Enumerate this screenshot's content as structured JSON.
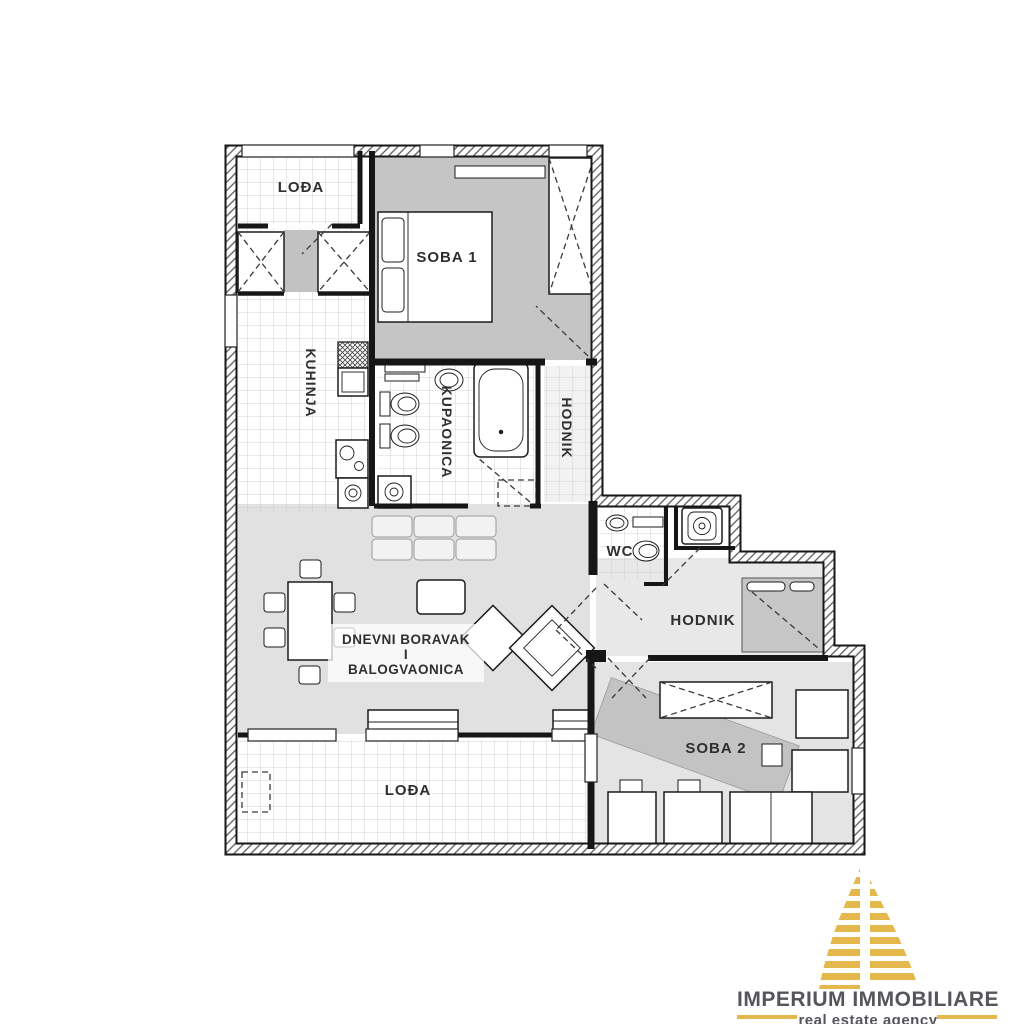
{
  "floorplan": {
    "rooms": {
      "loda_top": "LOĐA",
      "soba1": "SOBA 1",
      "kuhinja": "KUHINJA",
      "kupaonica": "KUPAONICA",
      "hodnik_upper": "HODNIK",
      "wc": "WC",
      "hodnik_lower": "HODNIK",
      "soba2": "SOBA 2",
      "dnevni_line1": "DNEVNI BORAVAK",
      "dnevni_line2": "I",
      "dnevni_line3": "BALOGVAONICA",
      "loda_bottom": "LOĐA"
    },
    "colors": {
      "wall": "#161616",
      "furniture_shade": "#c9c9c9",
      "tile_line": "#c6c6c6"
    }
  },
  "logo": {
    "title": "IMPERIUM IMMOBILIARE",
    "subtitle": "real estate agency",
    "colors": {
      "gold": "#e5b84d",
      "text": "#54565b"
    }
  }
}
